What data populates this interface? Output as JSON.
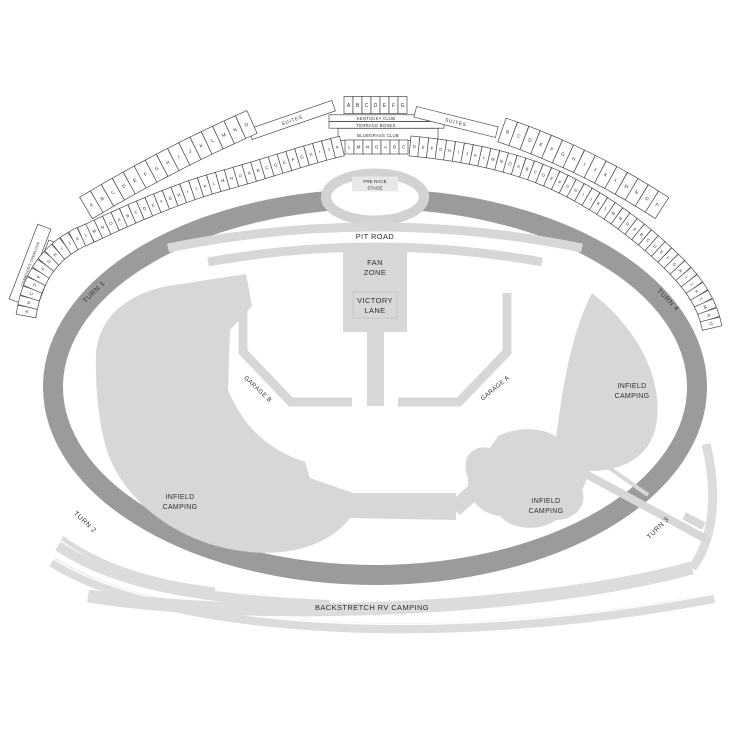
{
  "page": {
    "description": "Speedway seating and camping map"
  },
  "colors": {
    "track": "#9b9b9b",
    "infield_shape": "#d7d7d7",
    "ribbon": "#dcdcdc",
    "stage_ring": "#d2d2d2",
    "section_fill": "#ffffff",
    "section_border": "#4a4a4a",
    "label_text": "#2f2f2f",
    "stage_label_bg": "#e8e8e8"
  },
  "track": {
    "pit_road": "PIT ROAD",
    "turn_1": "TURN 1",
    "turn_2": "TURN 2",
    "turn_3": "TURN 3",
    "turn_4": "TURN 4",
    "backstretch": "BACKSTRETCH RV CAMPING"
  },
  "infield": {
    "pre_race_1": "PRE RACE",
    "pre_race_2": "STAGE",
    "fan_zone_1": "FAN",
    "fan_zone_2": "ZONE",
    "victory_1": "VICTORY",
    "victory_2": "LANE",
    "garage_a": "GARAGE A",
    "garage_b": "GARAGE B",
    "camping_left_1": "INFIELD",
    "camping_left_2": "CAMPING",
    "camping_center_1": "INFIELD",
    "camping_center_2": "CAMPING",
    "camping_right_1": "INFIELD",
    "camping_right_2": "CAMPING"
  },
  "clubs": {
    "kentucky": "KENTUCKY CLUB",
    "terrace": "TERRACE BOXES",
    "bluegrass": "BLUEGRASS CLUB",
    "suites_left": "SUITES",
    "suites_right": "SUITES",
    "champions_overlook": "CHAMPION'S OVERLOOK",
    "action_alley": "ACTION ALLEY"
  },
  "seating": {
    "top_boxes": "ABCDEFG",
    "center_row": "LMNOABC",
    "left_front": "ABCDEFGHIJKLMNOABCDEFGHIJKLMNOABCDEFGHIJK",
    "left_back": "ABCDEFGHIJKLMNO",
    "right_front": "DEFGHIJKLMNOABCDEFGHIJKLMNOABCDEFGHIJKLMNO",
    "right_back": "BCDEFGHIJKLMNOP"
  }
}
